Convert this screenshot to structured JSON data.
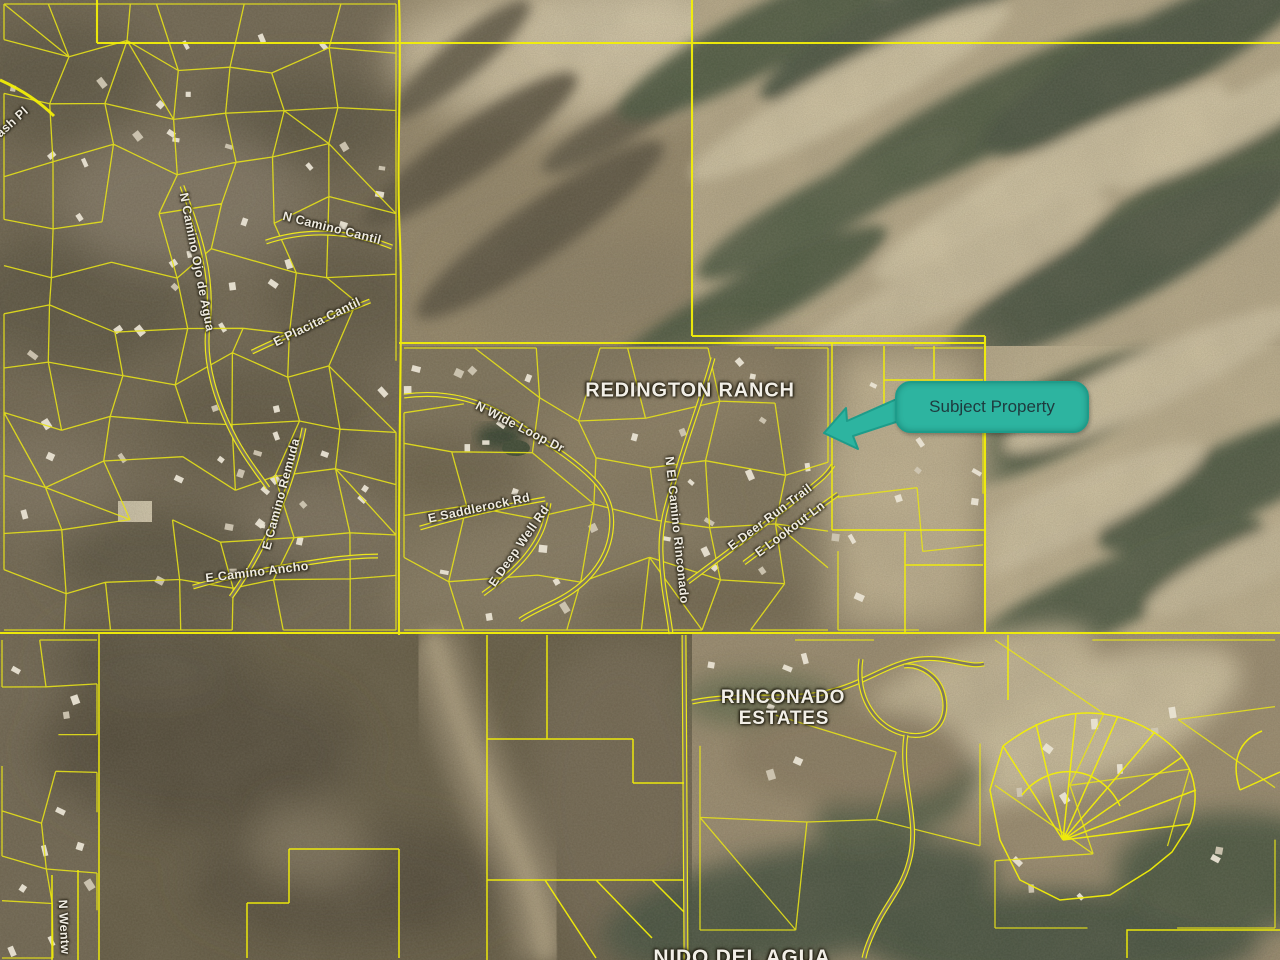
{
  "callout": {
    "label": "Subject Property",
    "bg_color": "#2db4a0",
    "border_color": "#1d9c8a",
    "text_color": "#1e3a3e"
  },
  "map_line_color": "#e8e316",
  "area_labels": [
    {
      "id": "redington-ranch",
      "text": "REDINGTON RANCH",
      "x": 690,
      "y": 391,
      "rot": 0,
      "size": 20
    },
    {
      "id": "rinconado",
      "text": "RINCONADO",
      "x": 783,
      "y": 698,
      "rot": 0,
      "size": 19
    },
    {
      "id": "rinconado-estates",
      "text": "ESTATES",
      "x": 784,
      "y": 719,
      "rot": 0,
      "size": 19
    },
    {
      "id": "nido-del-agua",
      "text": "NIDO DEL AGUA",
      "x": 742,
      "y": 958,
      "rot": 0,
      "size": 21
    }
  ],
  "street_labels": [
    {
      "id": "ash-pl",
      "text": "ash Pl",
      "x": 12,
      "y": 122,
      "rot": -42
    },
    {
      "id": "n-camino-cantil",
      "text": "N Camino Cantil",
      "x": 332,
      "y": 228,
      "rot": 14
    },
    {
      "id": "n-camino-ojo-de-agua",
      "text": "N Camino Ojo de Agua",
      "x": 197,
      "y": 262,
      "rot": 79
    },
    {
      "id": "e-placita-cantil",
      "text": "E Placita Cantil",
      "x": 317,
      "y": 322,
      "rot": -26
    },
    {
      "id": "e-camino-remuda",
      "text": "E Camino Remuda",
      "x": 281,
      "y": 494,
      "rot": -75
    },
    {
      "id": "e-camino-ancho",
      "text": "E Camino Ancho",
      "x": 257,
      "y": 572,
      "rot": -7
    },
    {
      "id": "n-wide-loop-dr",
      "text": "N Wide Loop Dr",
      "x": 520,
      "y": 427,
      "rot": 27
    },
    {
      "id": "e-saddlerock-rd",
      "text": "E Saddlerock Rd",
      "x": 479,
      "y": 508,
      "rot": -12
    },
    {
      "id": "e-deep-well-rd",
      "text": "E Deep Well Rd",
      "x": 519,
      "y": 546,
      "rot": -55
    },
    {
      "id": "n-el-camino-rinconado",
      "text": "N El Camino Rinconado",
      "x": 677,
      "y": 530,
      "rot": 84
    },
    {
      "id": "e-deer-run-trail",
      "text": "E Deer Run Trail",
      "x": 770,
      "y": 517,
      "rot": -37
    },
    {
      "id": "e-lookout-ln",
      "text": "E Lookout Ln",
      "x": 790,
      "y": 529,
      "rot": -37
    },
    {
      "id": "n-wentw",
      "text": "N Wentw",
      "x": 64,
      "y": 927,
      "rot": 87
    }
  ]
}
